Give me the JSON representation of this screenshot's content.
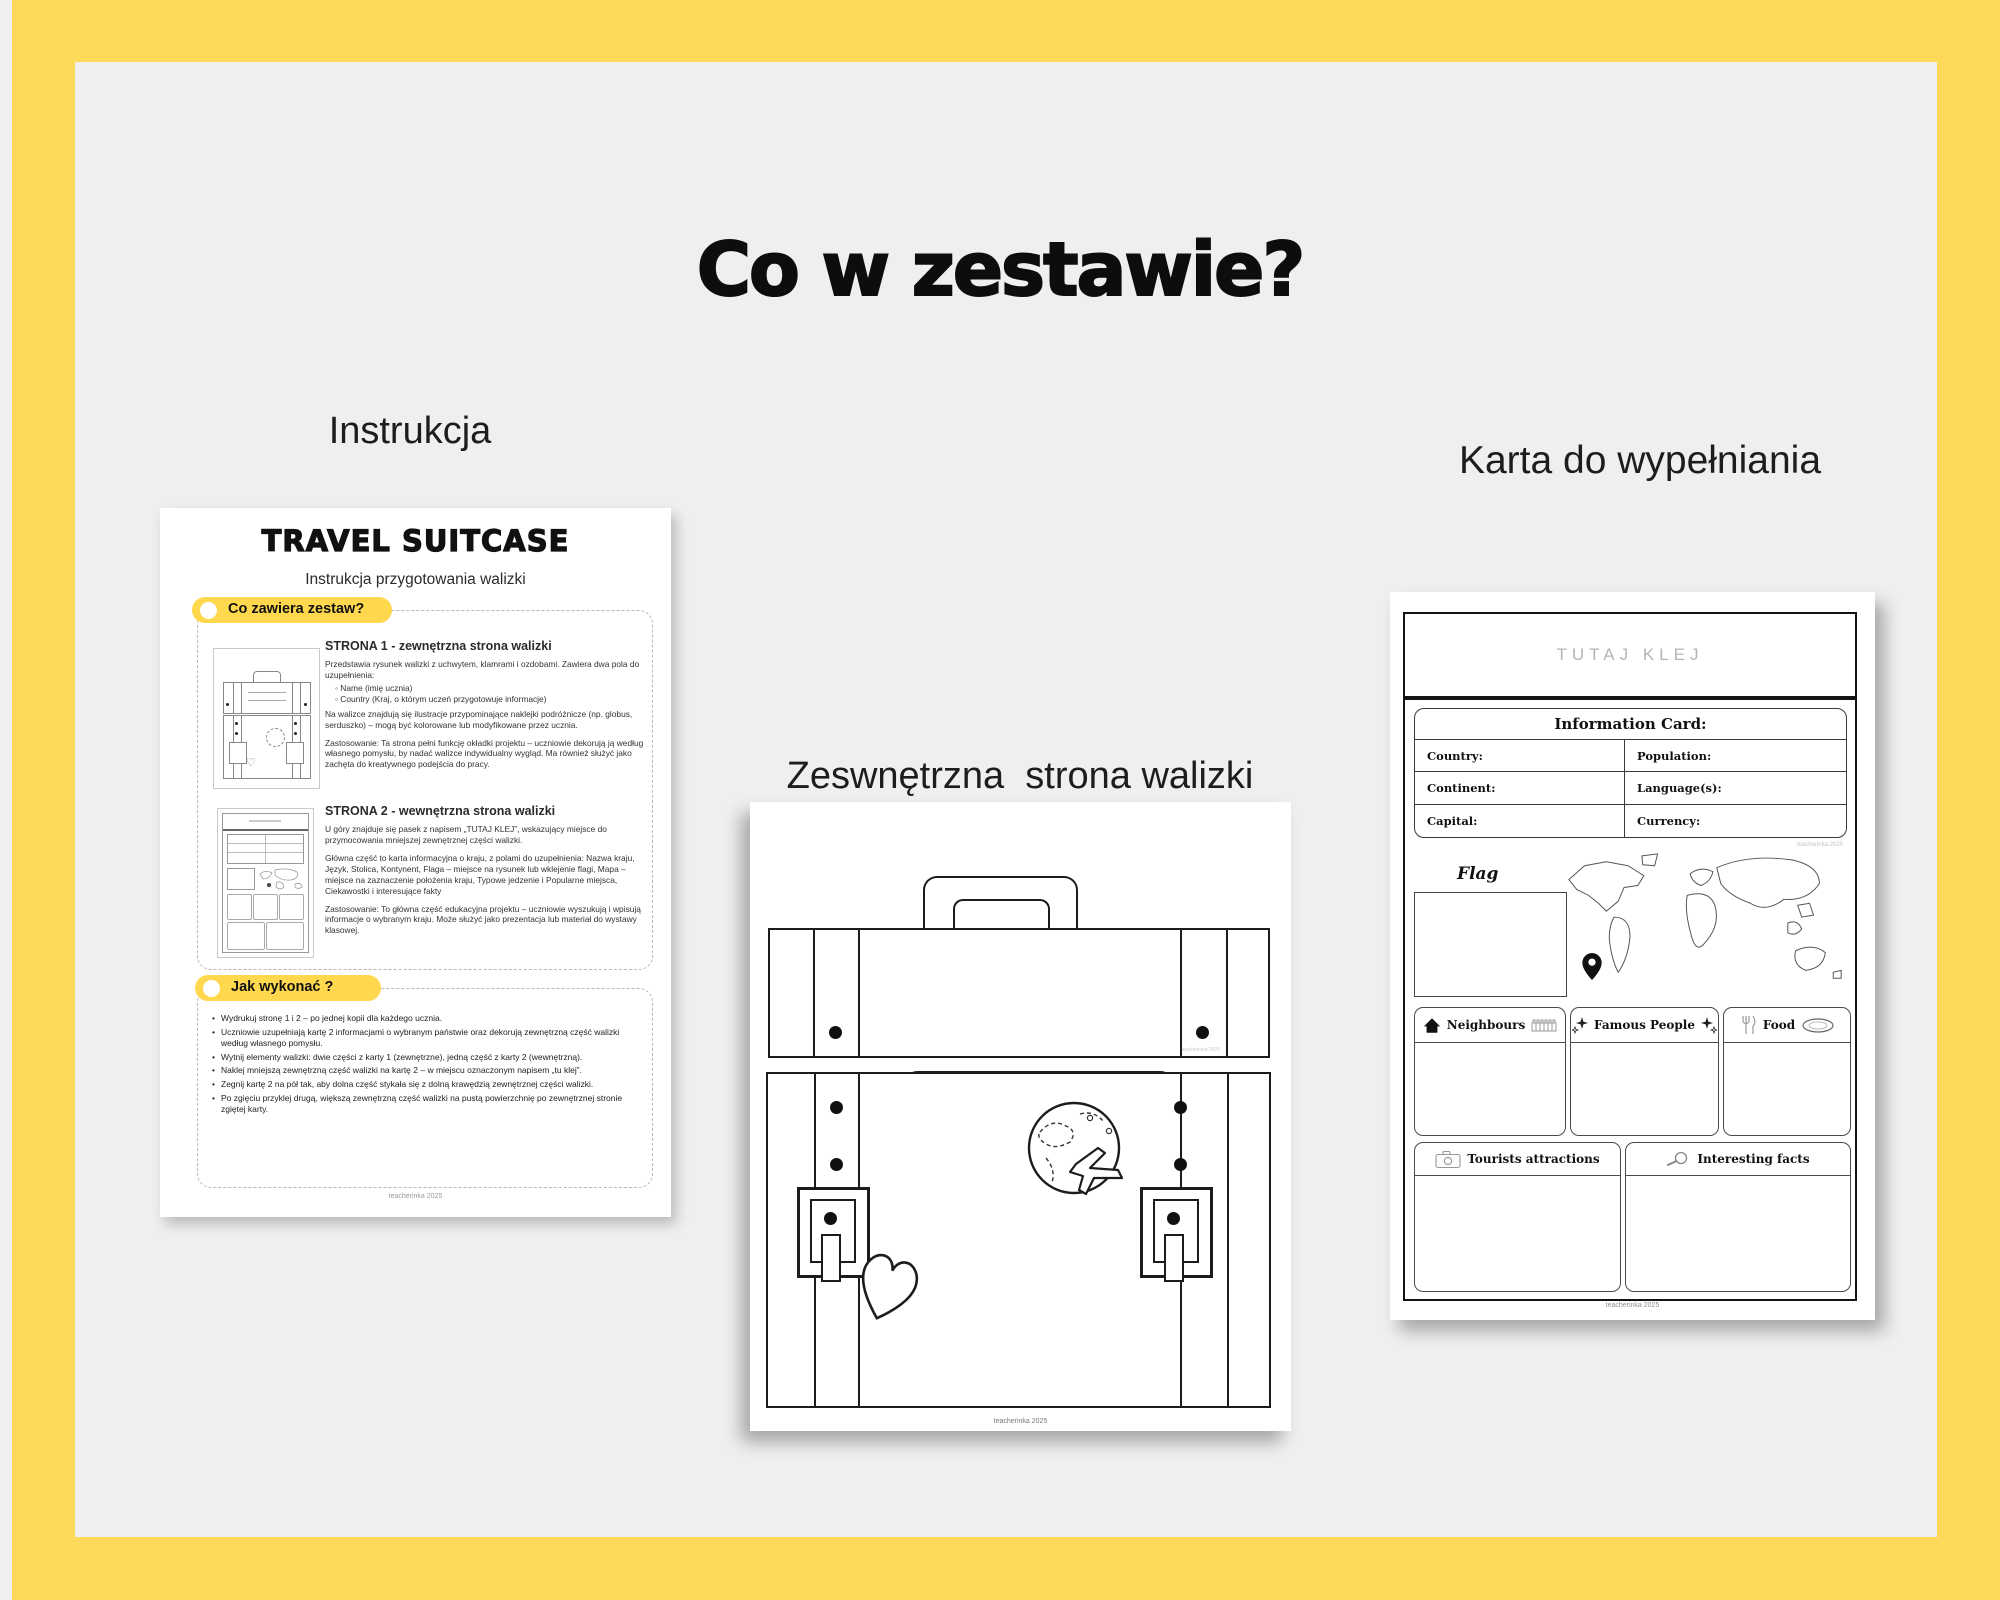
{
  "page": {
    "title": "Co w zestawie?",
    "colors": {
      "frame_yellow": "#FDD95A",
      "canvas_gray": "#EFEFEF",
      "pill_yellow": "#FFD84D",
      "page_white": "#FFFFFF",
      "glue_gray": "#B5B5B5",
      "ink_black": "#111111"
    }
  },
  "labels": {
    "left": "Instrukcja",
    "middle_1": "Zeswnętrzna  strona walizki",
    "middle_2": "do ozdobienia",
    "right": [
      "Karta do wypełniania",
      "informacjami",
      "o wybranym państwie",
      "(wnętrze walizki)"
    ]
  },
  "instruction_doc": {
    "title": "TRAVEL SUITCASE",
    "subtitle": "Instrukcja przygotowania walizki",
    "pill1": "Co zawiera zestaw?",
    "s1_heading": "STRONA 1 - zewnętrzna strona walizki",
    "s1_p1": "Przedstawia rysunek walizki z uchwytem, klamrami i ozdobami. Zawiera dwa pola do uzupełnienia:",
    "s1_b1": "Name (imię ucznia)",
    "s1_b2": "Country (Kraj, o którym uczeń przygotowuje informacje)",
    "s1_p2": "Na walizce znajdują się ilustracje przypominające naklejki podróżnicze (np. globus, serduszko) – mogą być kolorowane lub modyfikowane przez ucznia.",
    "s1_p3": "Zastosowanie: Ta strona pełni funkcję okładki projektu – uczniowie dekorują ją według własnego pomysłu, by nadać walizce indywidualny wygląd. Ma również służyć jako zachęta do kreatywnego podejścia do pracy.",
    "s2_heading": "STRONA 2 - wewnętrzna strona walizki",
    "s2_p1": "U góry znajduje się pasek z napisem „TUTAJ KLEJ”, wskazujący miejsce do przymocowania mniejszej zewnętrznej części walizki.",
    "s2_p2": "Główna część to karta informacyjna o kraju, z polami do uzupełnienia: Nazwa kraju, Język, Stolica, Kontynent, Flaga – miejsce na rysunek lub wklejenie flagi, Mapa – miejsce na zaznaczenie położenia kraju, Typowe jedzenie i Popularne miejsca, Ciekawostki i interesujące fakty",
    "s2_p3": "Zastosowanie: To główna część edukacyjna projektu – uczniowie wyszukują i wpisują informacje o wybranym kraju. Może służyć jako prezentacja lub materiał do wystawy klasowej.",
    "pill2": "Jak wykonać ?",
    "how": [
      "Wydrukuj stronę 1 i 2 – po jednej kopii dla każdego ucznia.",
      "Uczniowie uzupełniają kartę 2 informacjami o wybranym państwie oraz dekorują zewnętrzną część walizki według własnego pomysłu.",
      "Wytnij elementy walizki: dwie części z karty 1 (zewnętrzne), jedną część z karty 2 (wewnętrzną).",
      "Naklej mniejszą zewnętrzną część walizki na kartę 2 – w miejscu oznaczonym napisem „tu klej”.",
      "Zegnij kartę 2 na pół tak, aby dolna część stykała się z dolną krawędzią zewnętrznej części walizki.",
      "Po zgięciu przyklej drugą, większą zewnętrzną część walizki na pustą powierzchnię po zewnętrznej stronie zgiętej karty."
    ],
    "footer": "teacherinka 2025"
  },
  "suitcase_doc": {
    "name_label": "Name:",
    "name_dashes": "_ _ _ _ _ _ _ _ _ _",
    "country_label": "Country:",
    "country_dashes": "_ _ _ _ _ _ _ _ _",
    "watermark": "teacherinka 2025",
    "footer": "teacherinka 2025",
    "icons": [
      "globe-airplane-icon",
      "heart-icon",
      "buckle",
      "rivet-dots"
    ]
  },
  "info_card": {
    "glue_header": "TUTAJ KLEJ",
    "card_title": "Information Card:",
    "fields": {
      "country": "Country:",
      "population": "Population:",
      "continent": "Continent:",
      "languages": "Language(s):",
      "capital": "Capital:",
      "currency": "Currency:"
    },
    "watermark": "teacherinka 2025",
    "flag_label": "Flag",
    "boxes": {
      "neighbours": "Neighbours",
      "famous_people": "Famous People",
      "food": "Food",
      "tourists": "Tourists attractions",
      "facts": "Interesting facts"
    },
    "icons": [
      "house-icon",
      "fence-icon",
      "sparkles-icon",
      "cutlery-icon",
      "plate-icon",
      "camera-icon",
      "magnifier-icon",
      "map-pin-icon",
      "world-map"
    ],
    "footer": "teacherinka 2025"
  }
}
